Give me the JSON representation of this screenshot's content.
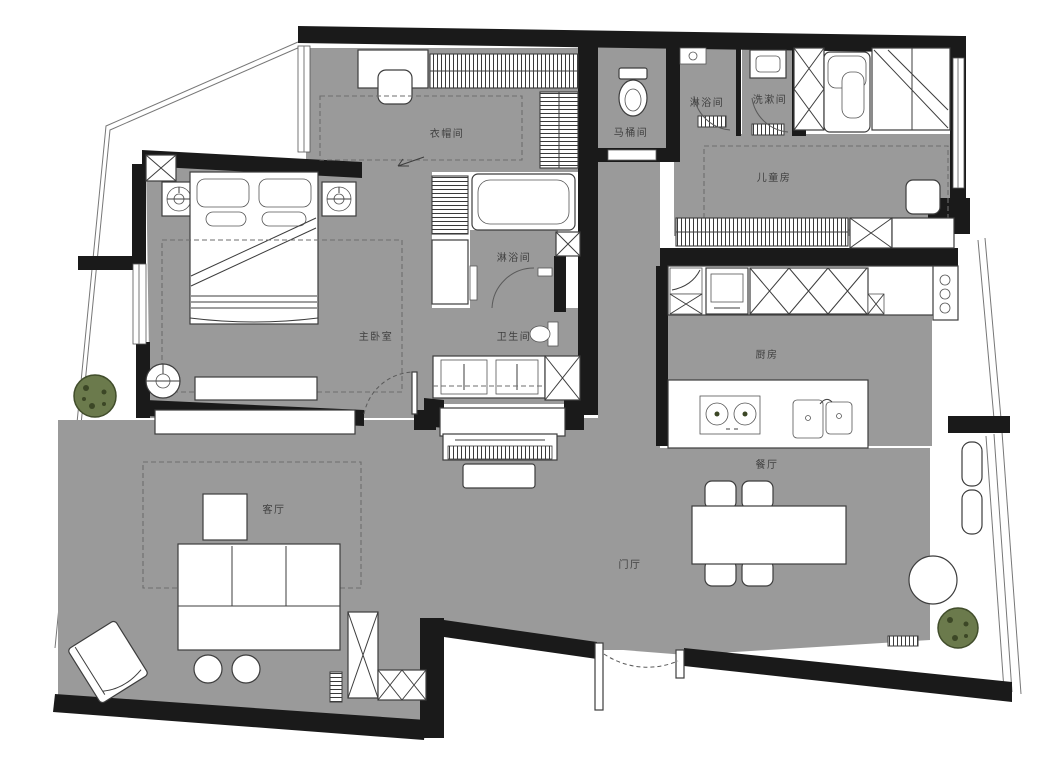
{
  "plan": {
    "title": "apartment floor plan",
    "rooms": {
      "cloakroom": {
        "label": "衣帽间"
      },
      "toilet_room": {
        "label": "马桶间"
      },
      "shower_room_top": {
        "label": "淋浴间"
      },
      "washroom": {
        "label": "洗漱间"
      },
      "kids_room": {
        "label": "儿童房"
      },
      "master_bedroom": {
        "label": "主卧室"
      },
      "shower_room_mid": {
        "label": "淋浴间"
      },
      "bathroom": {
        "label": "卫生间"
      },
      "kitchen": {
        "label": "厨房"
      },
      "dining_room": {
        "label": "餐厅"
      },
      "living_room": {
        "label": "客厅"
      },
      "foyer": {
        "label": "门厅"
      }
    },
    "colors": {
      "floor": "#9a9a9a",
      "wall": "#1a1a1a",
      "furniture": "#ffffff",
      "plant": "#6b7a4c",
      "background": "#ffffff"
    }
  }
}
